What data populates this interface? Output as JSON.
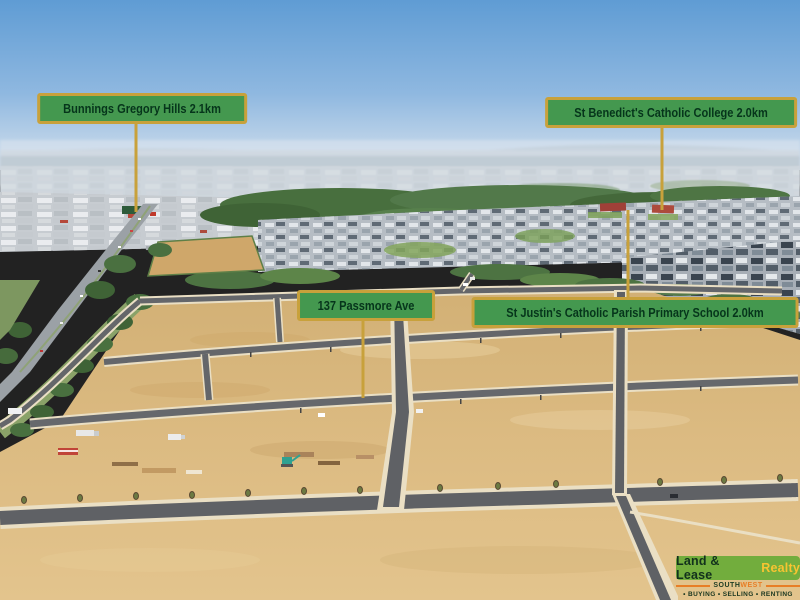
{
  "callouts": {
    "bunnings": "Bunnings Gregory Hills 2.1km",
    "college": "St Benedict's Catholic College 2.0km",
    "address": "137 Passmore Ave",
    "school": "St Justin's Catholic Parish Primary School 2.0km"
  },
  "logo": {
    "brand_primary": "Land & Lease",
    "brand_accent": "Realty",
    "region_primary": "SOUTH",
    "region_accent": "WEST",
    "tagline": "• BUYING  • SELLING  • RENTING"
  },
  "colors": {
    "callout_fill": "#44984f",
    "callout_border": "#c8a13b",
    "callout_text": "#06351b",
    "logo_green": "#72ad3d",
    "logo_yellow": "#f7c431",
    "logo_orange": "#e87e26"
  }
}
